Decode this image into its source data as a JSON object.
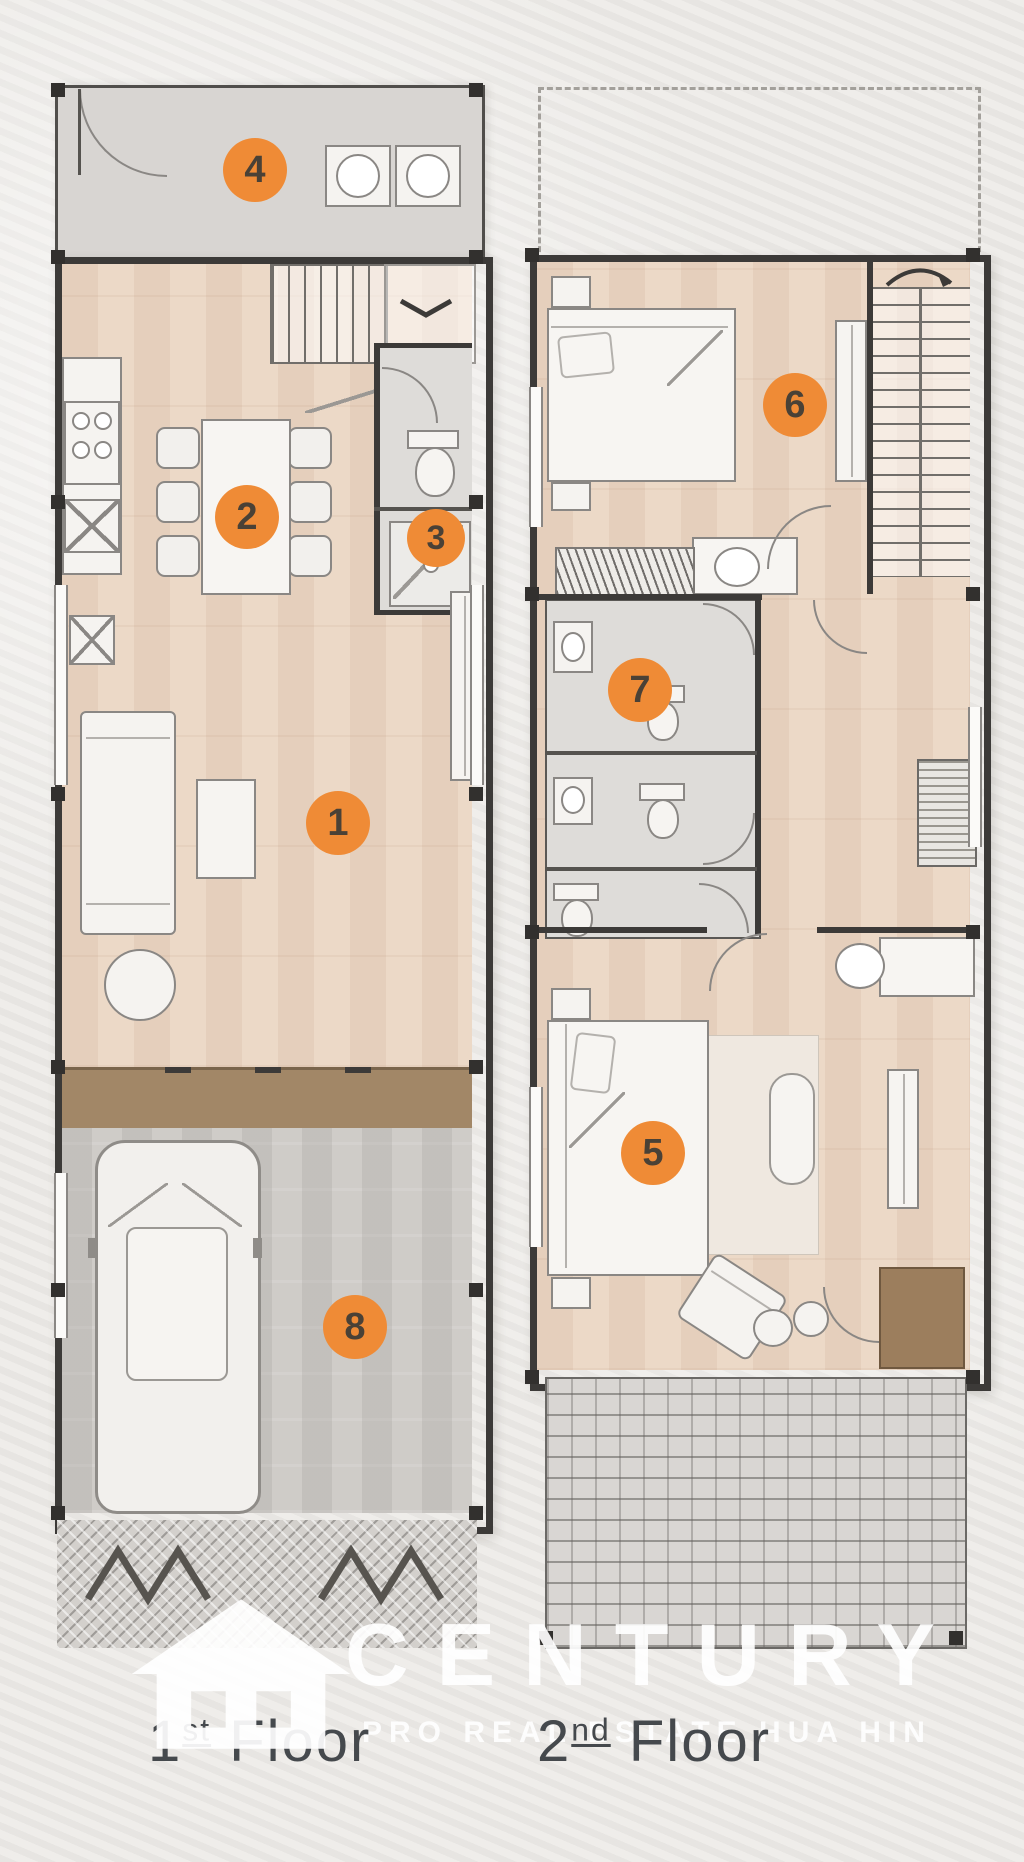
{
  "floors": {
    "first": {
      "number": "1",
      "ordinal": "st",
      "word": "Floor"
    },
    "second": {
      "number": "2",
      "ordinal": "nd",
      "word": "Floor"
    }
  },
  "markers": {
    "m1": "1",
    "m2": "2",
    "m3": "3",
    "m4": "4",
    "m5": "5",
    "m6": "6",
    "m7": "7",
    "m8": "8"
  },
  "watermark": {
    "brand": "CENTURY",
    "tagline": "PRO REAL ESTATE HUA HIN"
  },
  "colors": {
    "accent": "#EF8B36",
    "marker_number": "#4A4136",
    "wall": "#3C3A38",
    "wood_floor": "#ECD9C7",
    "gray_floor": "#D8D5D2",
    "garage_floor": "#CFCCC8",
    "threshold_brown": "#A28767",
    "closet_brown": "#9C7E5D",
    "label": "#45494D",
    "watermark": "#FFFFFF"
  }
}
